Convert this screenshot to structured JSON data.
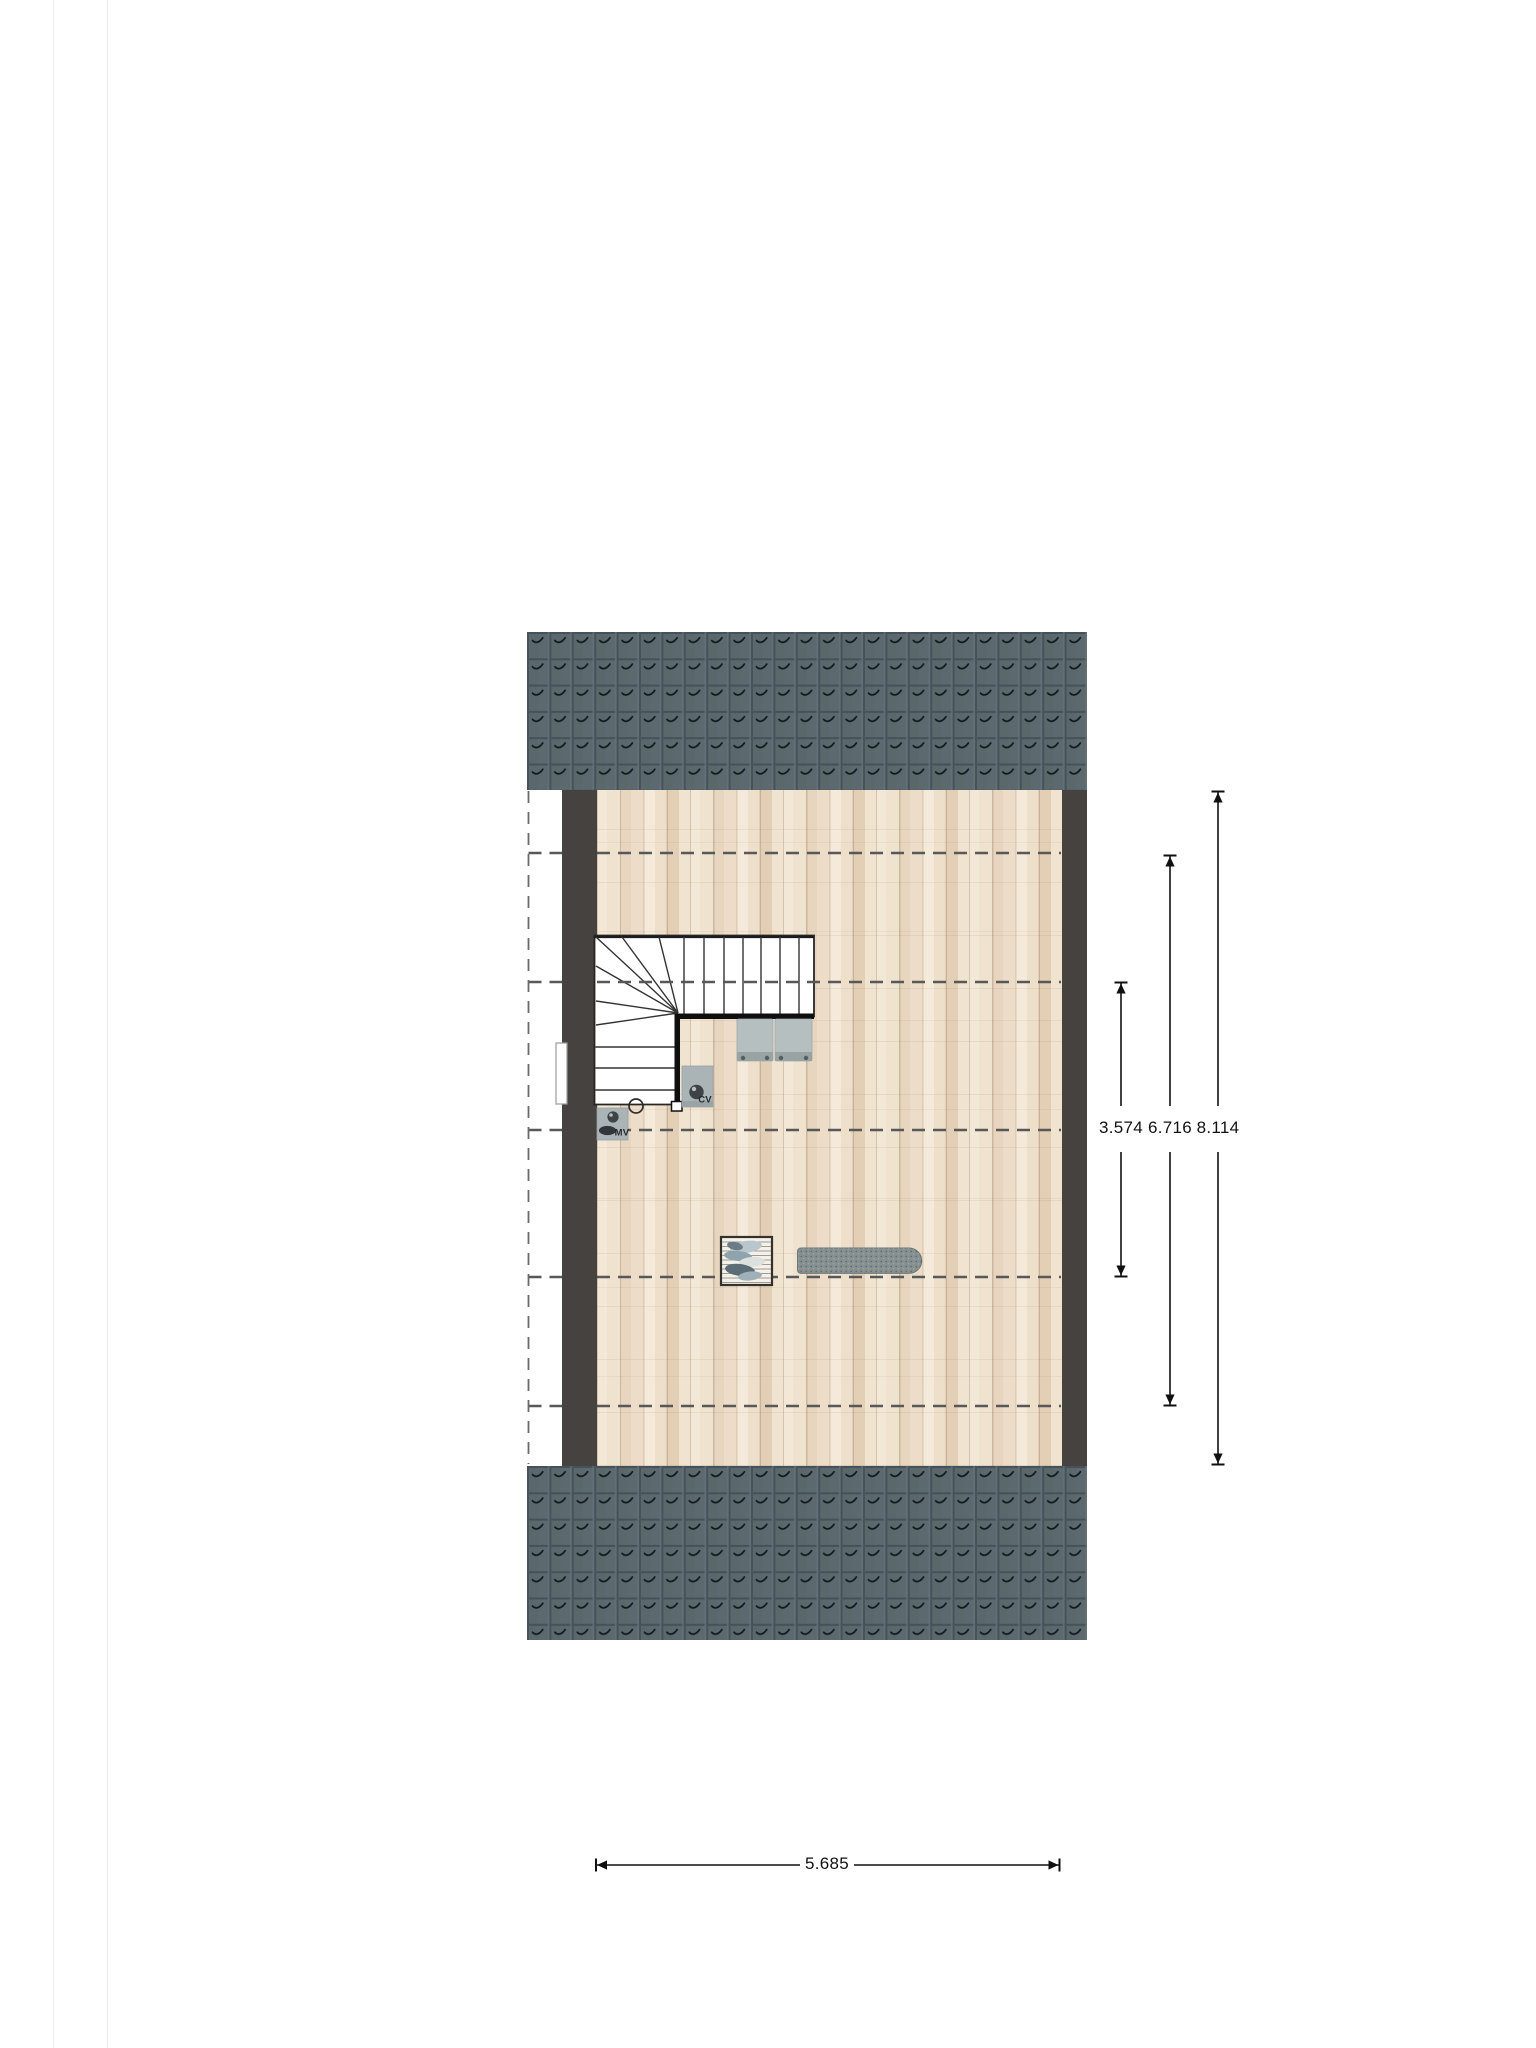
{
  "document": {
    "type": "attic floor plan drawing"
  },
  "dimension_labels": {
    "inner_vertical": "3.574",
    "middle_vertical": "6.716",
    "outer_vertical": "8.114",
    "bottom_horizontal": "5.685"
  },
  "equipment_labels": {
    "boiler": "CV",
    "ventilation": "MV"
  },
  "colors": {
    "roof_tile": "#5c696e",
    "roof_joint": "#46535b",
    "wall": "#454240",
    "floor_light": "#f3e7d6",
    "floor_dark": "#e3cfb5",
    "headroom_dash": "#585858",
    "dimension_line": "#101010",
    "unit_grey": "#aab4b6",
    "seat_grey": "#b6bfbf",
    "ironing_board_grey": "#879091"
  }
}
